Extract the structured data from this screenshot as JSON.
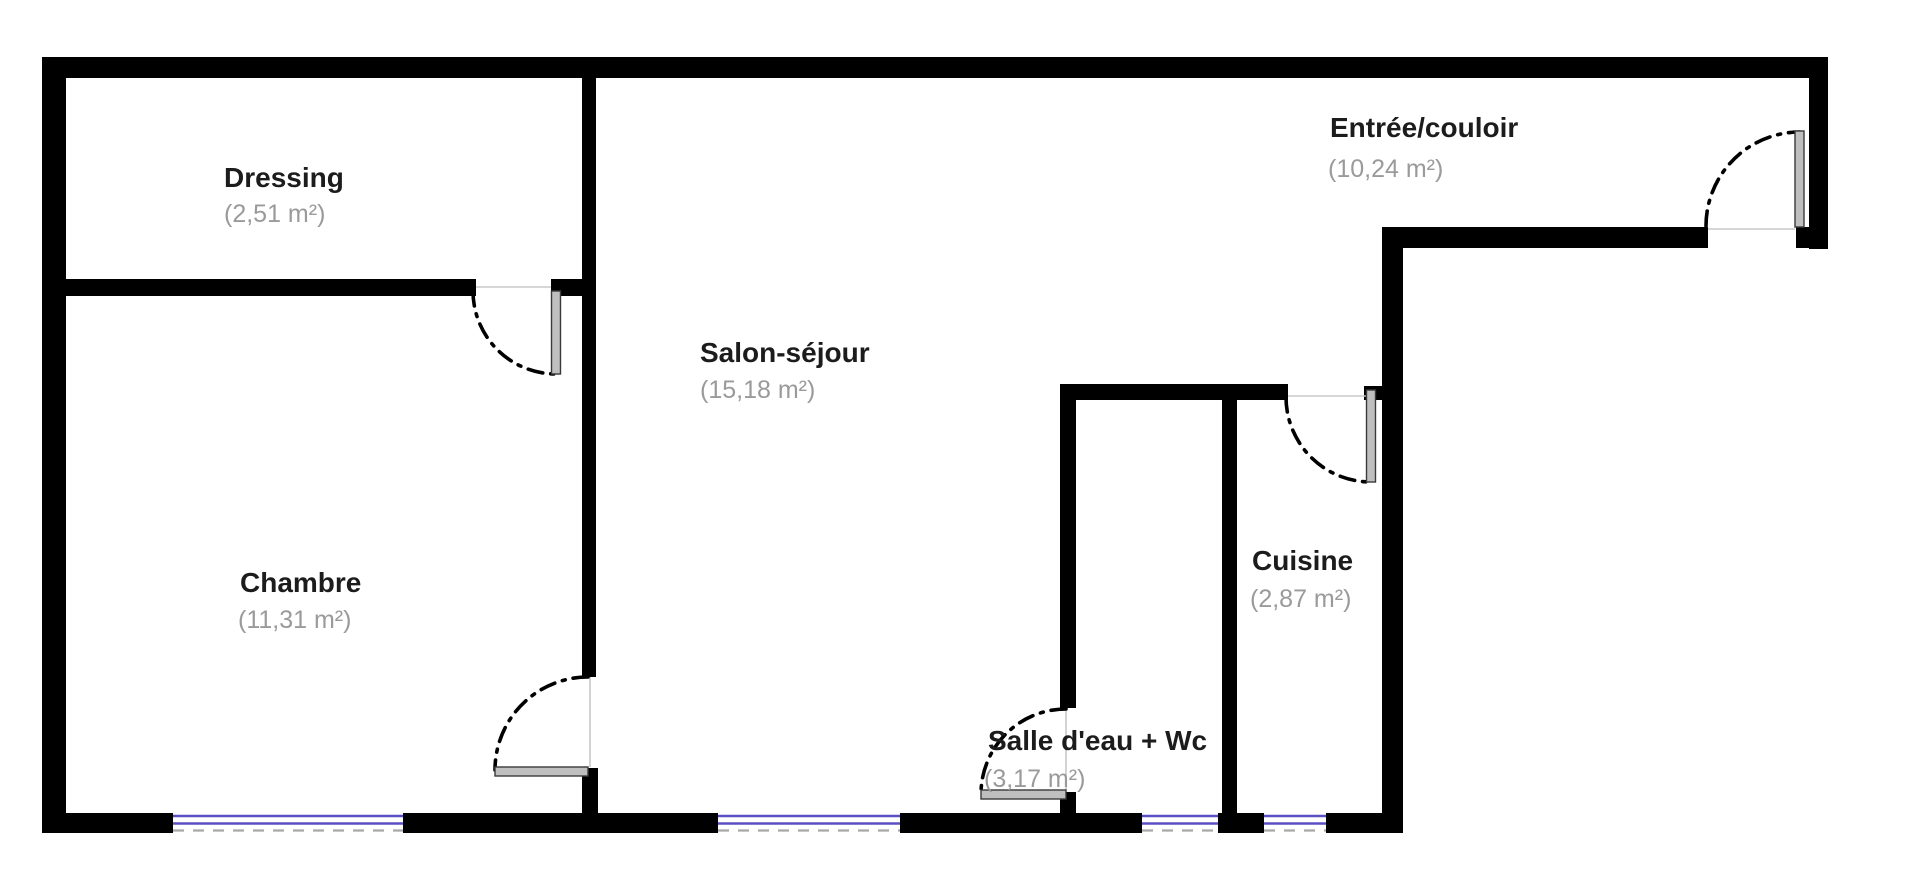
{
  "plan_title": "Apartment floor plan",
  "colors": {
    "wall": "#000000",
    "room_name": "#1c1c1c",
    "area_text": "#9a9a9a",
    "window_accent": "#5a50c3",
    "window_dash": "#a8a8a8",
    "door_leaf": "#bfbfbf",
    "door_leaf_edge": "#3a3a3a",
    "opening_line": "#c8c8c8"
  },
  "rooms": [
    {
      "name": "Dressing",
      "area_label": "(2,51 m²)",
      "area_m2": 2.51
    },
    {
      "name": "Chambre",
      "area_label": "(11,31 m²)",
      "area_m2": 11.31
    },
    {
      "name": "Salon-séjour",
      "area_label": "(15,18 m²)",
      "area_m2": 15.18
    },
    {
      "name": "Salle d'eau + Wc",
      "area_label": "(3,17 m²)",
      "area_m2": 3.17
    },
    {
      "name": "Cuisine",
      "area_label": "(2,87 m²)",
      "area_m2": 2.87
    },
    {
      "name": "Entrée/couloir",
      "area_label": "(10,24 m²)",
      "area_m2": 10.24
    }
  ]
}
